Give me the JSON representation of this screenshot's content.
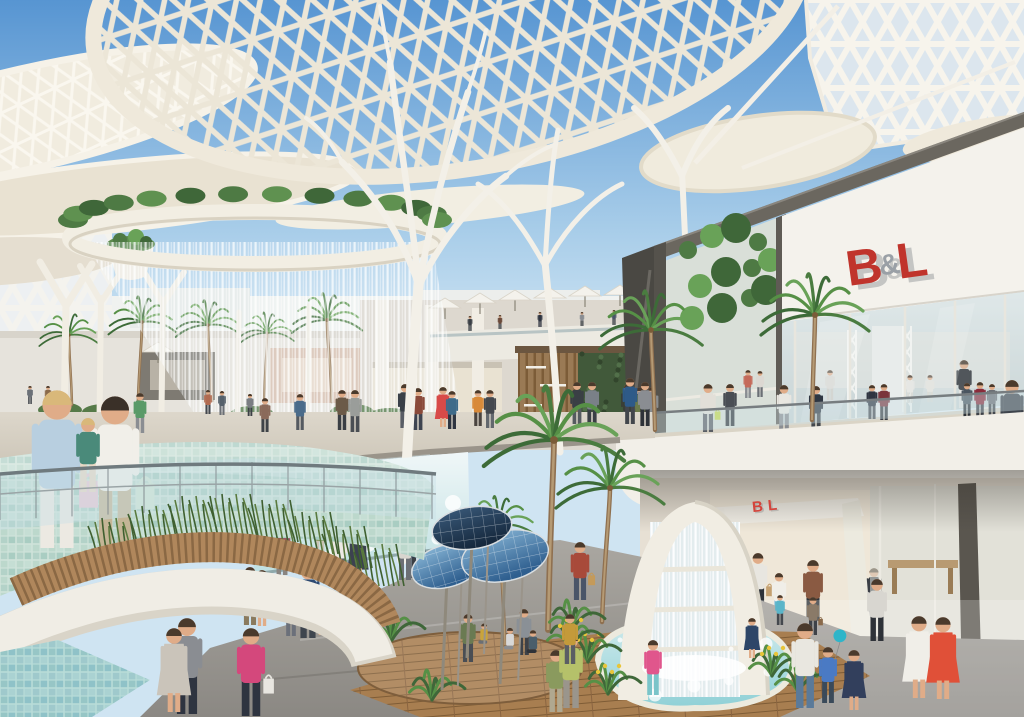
{
  "scene_title": "shopping-mall-atrium-rendering",
  "signs": {
    "upper": {
      "b": "B",
      "amp": "&",
      "l": "L"
    },
    "lower": {
      "b": "B",
      "l": "L"
    }
  },
  "colors": {
    "sky_top": "#5795d2",
    "sky_mid": "#bcdcf0",
    "sky_horizon": "#e9f4fa",
    "canopy_cream": "#ece6d7",
    "canopy_solid": "#f1ecdf",
    "structure_white": "#f3f0e8",
    "sign_red": "#c0342c",
    "sign_gray": "#9aa0a6",
    "bronze_beam": "#6b675f",
    "pool_light": "#cfeaec",
    "pool_deep": "#8fd0d6",
    "wood_slat": "#b0875c",
    "wood_slat_dark": "#8a6844",
    "boardwalk": "#a87e50",
    "mosaic_ramp": "#bcd8cc",
    "mosaic_water": "#9fc9cc",
    "plaza_gray": "#999690",
    "disc_blue": "#7fb2d6",
    "disc_blue_deep": "#2f5f8f",
    "disc_navy": "#16293e",
    "plant_green": "#4e7a44",
    "living_wall": "#41593a",
    "flower_yellow": "#e8c53a",
    "balloon_teal": "#2fb5c9"
  },
  "people": {
    "fields": [
      "x",
      "y",
      "h",
      "shirt",
      "pants",
      "layer",
      "flags",
      "accent",
      "hair"
    ],
    "items": [
      [
        30,
        404,
        18,
        "#6b7077",
        "#4a4e54",
        "far",
        "",
        "",
        ""
      ],
      [
        48,
        406,
        20,
        "#8a6a4a",
        "#3e4246",
        "far",
        "",
        "",
        ""
      ],
      [
        208,
        414,
        24,
        "#b06a50",
        "#44484e",
        "far",
        "",
        "",
        ""
      ],
      [
        222,
        415,
        24,
        "#55606b",
        "#6b6f75",
        "far",
        "",
        "",
        ""
      ],
      [
        250,
        416,
        22,
        "#7a7d82",
        "#3c4046",
        "far",
        "",
        "",
        ""
      ],
      [
        140,
        433,
        40,
        "#5a9a68",
        "#8a8d92",
        "far",
        "",
        "",
        ""
      ],
      [
        265,
        432,
        34,
        "#8a6a5a",
        "#3e4348",
        "far",
        "",
        "",
        ""
      ],
      [
        300,
        430,
        36,
        "#4a6b8a",
        "#555a60",
        "far",
        "",
        "",
        ""
      ],
      [
        342,
        430,
        40,
        "#6b5a48",
        "#3a3f45",
        "far",
        "",
        "",
        ""
      ],
      [
        355,
        432,
        42,
        "#9a9d9a",
        "#4a4e54",
        "far",
        "",
        "",
        ""
      ],
      [
        405,
        428,
        44,
        "#3a4048",
        "#5a5e66",
        "far",
        "",
        "",
        ""
      ],
      [
        418,
        430,
        42,
        "#8a4a3a",
        "#3e4450",
        "far",
        "",
        "",
        ""
      ],
      [
        443,
        427,
        40,
        "#d84a48",
        "#4a4f57",
        "far",
        "d",
        "",
        ""
      ],
      [
        452,
        429,
        38,
        "#3e6b8a",
        "#2e3440",
        "far",
        "",
        "",
        ""
      ],
      [
        478,
        426,
        36,
        "#d88a3a",
        "#4a4440",
        "far",
        "",
        "",
        ""
      ],
      [
        490,
        428,
        38,
        "#44484e",
        "#63686e",
        "far",
        "",
        "",
        ""
      ],
      [
        577,
        424,
        42,
        "#3a3f45",
        "#565b60",
        "far",
        "",
        "",
        ""
      ],
      [
        592,
        426,
        44,
        "#7a8088",
        "#3a3f45",
        "far",
        "",
        "",
        ""
      ],
      [
        630,
        424,
        46,
        "#2e5a88",
        "#42464c",
        "far",
        "",
        "",
        ""
      ],
      [
        645,
        426,
        44,
        "#8a8d92",
        "#2e3238",
        "far",
        "",
        "",
        ""
      ],
      [
        748,
        398,
        28,
        "#c46a5a",
        "#8a8d92",
        "far",
        "",
        "",
        ""
      ],
      [
        760,
        397,
        26,
        "#dcd8d2",
        "#6b6f75",
        "far",
        "",
        "",
        ""
      ],
      [
        470,
        331,
        15,
        "#3a3f45",
        "#3a3f45",
        "terr",
        "",
        "",
        ""
      ],
      [
        500,
        329,
        14,
        "#6b4a3a",
        "#3a3f45",
        "terr",
        "",
        "",
        ""
      ],
      [
        540,
        327,
        15,
        "#2e3440",
        "#2e3440",
        "terr",
        "",
        "",
        ""
      ],
      [
        582,
        326,
        14,
        "#8a8d92",
        "#3a3f45",
        "terr",
        "",
        "",
        ""
      ],
      [
        614,
        325,
        15,
        "#4a5568",
        "#3a3f45",
        "terr",
        "",
        "",
        ""
      ],
      [
        642,
        327,
        14,
        "#5a5e64",
        "#3a3f45",
        "terr",
        "",
        "",
        ""
      ],
      [
        910,
        403,
        28,
        "#eceae4",
        "#dddbd4",
        "store",
        "",
        "",
        ""
      ],
      [
        930,
        402,
        27,
        "#e4e2da",
        "#d6d4cc",
        "store",
        "",
        "",
        ""
      ],
      [
        964,
        408,
        48,
        "#26292e",
        "#e8e6e0",
        "store",
        "",
        "",
        ""
      ],
      [
        830,
        400,
        30,
        "#d8d6d0",
        "#c9c7c0",
        "store",
        "",
        "",
        ""
      ],
      [
        628,
        428,
        44,
        "#3a3f35",
        "#55595f",
        "walkB",
        "",
        "",
        ""
      ],
      [
        640,
        429,
        42,
        "#6b7a4a",
        "#4a4e54",
        "walkB",
        "",
        "",
        ""
      ],
      [
        652,
        427,
        40,
        "#8a8d90",
        "#3a3e44",
        "walkB",
        "",
        "",
        ""
      ],
      [
        708,
        432,
        48,
        "#e2dfd8",
        "#5a5e64",
        "walkB",
        "b",
        "#c6d94a",
        ""
      ],
      [
        730,
        426,
        42,
        "#4a4e54",
        "#2e3238",
        "walkB",
        "",
        "",
        ""
      ],
      [
        784,
        431,
        46,
        "#e8e6e0",
        "#8a8d92",
        "walkB",
        "",
        "",
        ""
      ],
      [
        816,
        430,
        44,
        "#2e3642",
        "#44484e",
        "walkB",
        "",
        "",
        ""
      ],
      [
        872,
        419,
        34,
        "#2e3440",
        "#4a4e54",
        "walkB",
        "",
        "",
        ""
      ],
      [
        884,
        420,
        36,
        "#7a343c",
        "#3a3e44",
        "walkB",
        "",
        "",
        ""
      ],
      [
        967,
        417,
        34,
        "#4a5560",
        "#2e3238",
        "walkB",
        "",
        "",
        ""
      ],
      [
        980,
        418,
        36,
        "#8a2a3a",
        "#3e4248",
        "walkB",
        "",
        "",
        ""
      ],
      [
        992,
        416,
        32,
        "#6b6f75",
        "#44484e",
        "walkB",
        "",
        "",
        ""
      ],
      [
        1012,
        452,
        72,
        "#3e444c",
        "#2e3238",
        "walkB",
        "",
        "",
        ""
      ],
      [
        758,
        611,
        58,
        "#e8e6e0",
        "#2e3238",
        "storeL",
        "b",
        "#c4a070",
        ""
      ],
      [
        779,
        618,
        45,
        "#f0eee8",
        "#7ab5d6",
        "storeL",
        "",
        "",
        ""
      ],
      [
        813,
        622,
        62,
        "#8a5a42",
        "#2e3238",
        "storeL",
        "",
        "",
        ""
      ],
      [
        874,
        616,
        48,
        "#3a3f45",
        "#8a8d92",
        "storeL",
        "",
        "",
        ""
      ],
      [
        282,
        575,
        52,
        "#9a5462",
        "#8a8580",
        "plaza",
        "",
        "",
        ""
      ],
      [
        320,
        556,
        40,
        "#8a9a6a",
        "#c9c4b4",
        "plaza",
        "",
        "",
        ""
      ],
      [
        340,
        578,
        52,
        "#ece9e4",
        "#5a6470",
        "plaza",
        "",
        "",
        ""
      ],
      [
        358,
        580,
        52,
        "#3c4250",
        "#3c4250",
        "plaza",
        "d",
        "",
        ""
      ],
      [
        405,
        580,
        57,
        "#d8d5cf",
        "#6b6f75",
        "plaza",
        "",
        "",
        ""
      ],
      [
        417,
        578,
        54,
        "#2e3a4e",
        "#3a3f45",
        "plaza",
        "",
        "",
        ""
      ],
      [
        308,
        638,
        72,
        "#2e4a72",
        "#3e454e",
        "plaza",
        "",
        "",
        ""
      ],
      [
        291,
        636,
        46,
        "#4a5e7a",
        "#6b707a",
        "plaza",
        "",
        "",
        ""
      ],
      [
        322,
        635,
        44,
        "#e8e4da",
        "#e8e4da",
        "plaza",
        "d",
        "",
        ""
      ],
      [
        250,
        625,
        58,
        "#6b4a3e",
        "#8a7a5e",
        "plaza",
        "",
        "",
        ""
      ],
      [
        262,
        626,
        56,
        "#7a2e38",
        "#3a3f45",
        "plaza",
        "d",
        "",
        ""
      ],
      [
        187,
        714,
        96,
        "#8a8d92",
        "#2e3440",
        "plaza",
        "",
        "",
        ""
      ],
      [
        174,
        712,
        84,
        "#cac4ba",
        "#b8c4b0",
        "plaza",
        "d",
        "",
        ""
      ],
      [
        251,
        716,
        88,
        "#d4487c",
        "#2e3440",
        "plaza",
        "b",
        "#e8e6e0",
        ""
      ],
      [
        580,
        600,
        58,
        "#a84a3a",
        "#4a5568",
        "plaza",
        "b",
        "#c49a5a",
        ""
      ],
      [
        556,
        712,
        62,
        "#8a9a5e",
        "#b0a890",
        "plaza",
        "",
        "",
        ""
      ],
      [
        571,
        708,
        74,
        "#b5c16a",
        "#9a958c",
        "plaza",
        "",
        "",
        ""
      ],
      [
        780,
        625,
        30,
        "#5ab5c9",
        "#44484e",
        "plaza",
        "",
        "",
        ""
      ],
      [
        813,
        635,
        38,
        "#8a7a68",
        "#3e4248",
        "plaza",
        "b",
        "#8a6a4a",
        ""
      ],
      [
        653,
        695,
        55,
        "#e0568c",
        "#7ac4c9",
        "plaza",
        "",
        "",
        ""
      ],
      [
        752,
        658,
        40,
        "#2e4668",
        "#3a3f45",
        "plaza",
        "d",
        "",
        ""
      ],
      [
        805,
        708,
        85,
        "#e9e7e0",
        "#5a7a9a",
        "plaza",
        "",
        "",
        ""
      ],
      [
        828,
        703,
        56,
        "#4a7ac4",
        "#3a4a5a",
        "plaza",
        "o",
        "#2fb5c9",
        ""
      ],
      [
        854,
        710,
        60,
        "#323f5c",
        "#323f5c",
        "plaza",
        "d",
        "",
        ""
      ],
      [
        919,
        698,
        82,
        "#f0eee8",
        "#f0eee8",
        "plaza",
        "d",
        "",
        ""
      ],
      [
        943,
        699,
        82,
        "#e05038",
        "#e05038",
        "plaza",
        "d",
        "",
        ""
      ],
      [
        877,
        641,
        62,
        "#d8d6d0",
        "#2e3238",
        "plaza",
        "",
        "",
        ""
      ],
      [
        468,
        662,
        48,
        "#6a7a52",
        "#4a4e54",
        "deck",
        "",
        "",
        ""
      ],
      [
        484,
        650,
        32,
        "#c9a43a",
        "#6b6f75",
        "deck",
        "s",
        "",
        ""
      ],
      [
        510,
        656,
        34,
        "#d8d8d8",
        "#8a8d92",
        "deck",
        "s",
        "",
        ""
      ],
      [
        524,
        655,
        46,
        "#8a9096",
        "#3e4248",
        "deck",
        "",
        "",
        ""
      ],
      [
        533,
        660,
        36,
        "#4a5e6b",
        "#2e3238",
        "deck",
        "s",
        "",
        ""
      ],
      [
        570,
        664,
        50,
        "#c49a3a",
        "#5a5e64",
        "deck",
        "",
        "",
        ""
      ],
      [
        57,
        548,
        158,
        "#b8cfe0",
        "#ece9e2",
        "fore",
        "b",
        "#e8c9d4",
        "#d9b87a"
      ],
      [
        115,
        548,
        152,
        "#f1efe9",
        "#c4b596",
        "fore",
        "b",
        "#cfe4d2",
        "#3a3028"
      ],
      [
        88,
        492,
        74,
        "#4a8a7a",
        "#e8d8c4",
        "fore",
        "",
        "",
        "#d9b87a"
      ]
    ]
  },
  "palms": {
    "fields": [
      "x",
      "y",
      "top",
      "lean",
      "s"
    ],
    "items": [
      [
        72,
        405,
        335,
        -3,
        0.55
      ],
      [
        138,
        403,
        322,
        4,
        0.62
      ],
      [
        212,
        401,
        325,
        -4,
        0.6
      ],
      [
        264,
        399,
        333,
        3,
        0.5
      ],
      [
        332,
        402,
        320,
        -5,
        0.65
      ],
      [
        655,
        430,
        330,
        -4,
        0.95
      ],
      [
        812,
        420,
        315,
        3,
        1.0
      ],
      [
        548,
        630,
        440,
        6,
        1.3
      ],
      [
        602,
        622,
        488,
        8,
        1.0
      ],
      [
        505,
        645,
        525,
        -6,
        0.7
      ]
    ]
  },
  "discs": {
    "fields": [
      "cx",
      "cy",
      "rx",
      "ry",
      "rot",
      "py",
      "dark"
    ],
    "items": [
      [
        447,
        566,
        36,
        21,
        -16,
        690,
        0
      ],
      [
        505,
        556,
        44,
        25,
        -12,
        684,
        0
      ],
      [
        472,
        528,
        40,
        21,
        -8,
        658,
        1
      ]
    ]
  },
  "umbrellas": {
    "fields": [
      "x",
      "y"
    ],
    "items": [
      [
        445,
        308
      ],
      [
        480,
        303
      ],
      [
        515,
        300
      ],
      [
        550,
        298
      ],
      [
        585,
        296
      ],
      [
        620,
        295
      ],
      [
        650,
        295
      ],
      [
        158,
        352
      ]
    ]
  },
  "shrub_ring": {
    "cx": 255,
    "cy": 224,
    "rx": 182,
    "ry": 26,
    "count": 14
  },
  "grass_clusters": [
    [
      118,
      560
    ],
    [
      158,
      548
    ],
    [
      198,
      538
    ],
    [
      238,
      536
    ],
    [
      278,
      542
    ],
    [
      318,
      554
    ],
    [
      352,
      568
    ],
    [
      384,
      586
    ]
  ],
  "tropical_plants": [
    [
      588,
      662,
      1
    ],
    [
      608,
      694,
      1
    ],
    [
      572,
      630,
      0
    ],
    [
      772,
      676,
      1
    ],
    [
      798,
      692,
      0
    ],
    [
      392,
      640,
      0
    ],
    [
      570,
      648,
      1
    ],
    [
      432,
      700,
      0
    ]
  ],
  "hedges": [
    [
      60,
      410
    ],
    [
      104,
      412
    ],
    [
      252,
      414
    ],
    [
      352,
      412
    ],
    [
      390,
      416
    ]
  ],
  "bay_foliage": [
    [
      688,
      250
    ],
    [
      712,
      236
    ],
    [
      736,
      228
    ],
    [
      758,
      242
    ],
    [
      700,
      286
    ],
    [
      726,
      272
    ],
    [
      752,
      268
    ],
    [
      692,
      318
    ],
    [
      722,
      308
    ],
    [
      750,
      298
    ],
    [
      770,
      260
    ],
    [
      766,
      290
    ]
  ]
}
